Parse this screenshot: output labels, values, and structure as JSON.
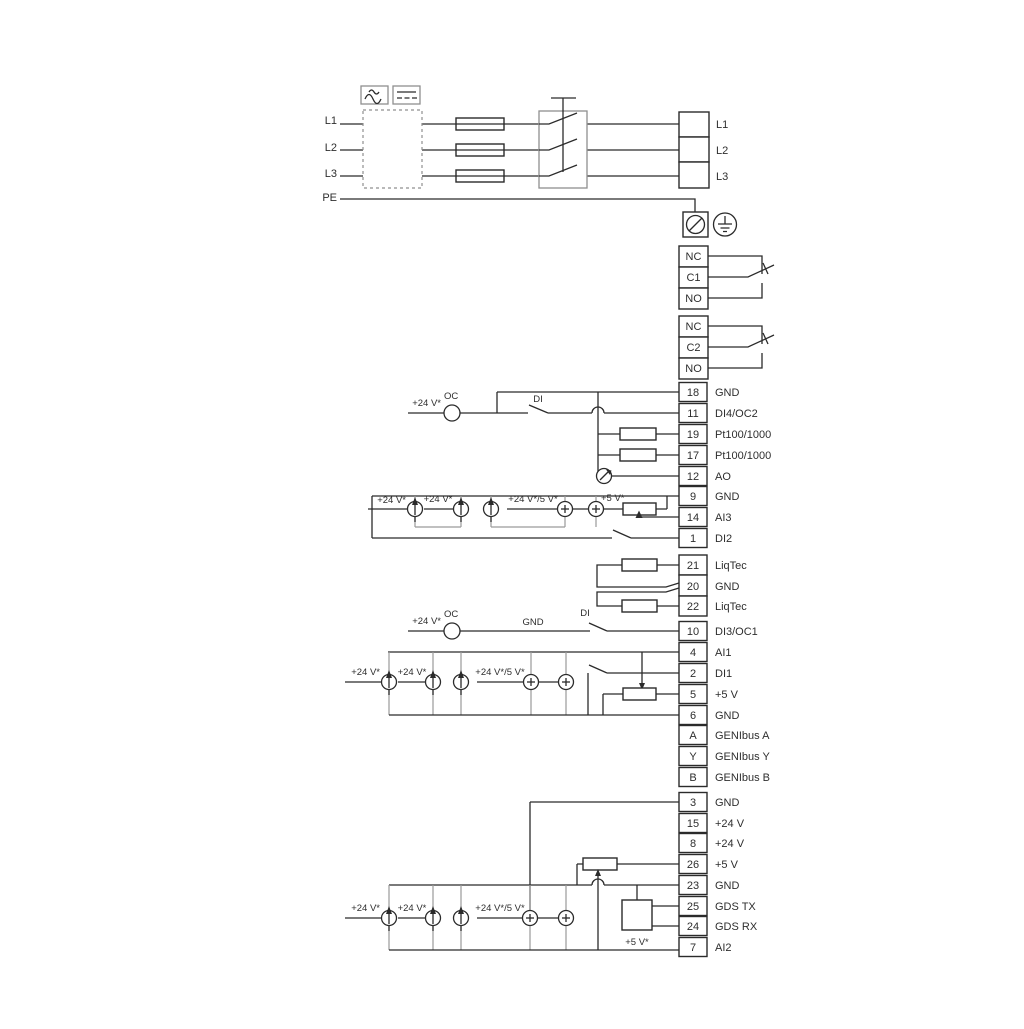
{
  "page": {
    "background": "#ffffff",
    "line_color": "#2b2b2b",
    "muted_line_color": "#9a9a9a"
  },
  "labels": {
    "v24": "+24 V*",
    "v24_5": "+24 V*/5 V*",
    "v5": "+5 V*",
    "oc": "OC",
    "di": "DI",
    "gnd": "GND"
  },
  "mains": {
    "inputs": [
      "L1",
      "L2",
      "L3",
      "PE"
    ],
    "outputs": [
      "L1",
      "L2",
      "L3"
    ]
  },
  "relays": {
    "relay1": [
      "NC",
      "C1",
      "NO"
    ],
    "relay2": [
      "NC",
      "C2",
      "NO"
    ]
  },
  "terminals": {
    "group_a": [
      {
        "n": "18",
        "label": "GND"
      },
      {
        "n": "11",
        "label": "DI4/OC2"
      },
      {
        "n": "19",
        "label": "Pt100/1000"
      },
      {
        "n": "17",
        "label": "Pt100/1000"
      },
      {
        "n": "12",
        "label": "AO"
      },
      {
        "n": "9",
        "label": "GND"
      },
      {
        "n": "14",
        "label": "AI3"
      },
      {
        "n": "1",
        "label": "DI2"
      }
    ],
    "liqtec": [
      {
        "n": "21",
        "label": "LiqTec"
      },
      {
        "n": "20",
        "label": "GND"
      },
      {
        "n": "22",
        "label": "LiqTec"
      }
    ],
    "group_b": [
      {
        "n": "10",
        "label": "DI3/OC1"
      },
      {
        "n": "4",
        "label": "AI1"
      },
      {
        "n": "2",
        "label": "DI1"
      },
      {
        "n": "5",
        "label": "+5 V"
      },
      {
        "n": "6",
        "label": "GND"
      },
      {
        "n": "A",
        "label": "GENIbus A"
      },
      {
        "n": "Y",
        "label": "GENIbus Y"
      },
      {
        "n": "B",
        "label": "GENIbus B"
      }
    ],
    "group_c": [
      {
        "n": "3",
        "label": "GND"
      },
      {
        "n": "15",
        "label": "+24 V"
      },
      {
        "n": "8",
        "label": "+24 V"
      },
      {
        "n": "26",
        "label": "+5 V"
      },
      {
        "n": "23",
        "label": "GND"
      },
      {
        "n": "25",
        "label": "GDS TX"
      },
      {
        "n": "24",
        "label": "GDS RX"
      },
      {
        "n": "7",
        "label": "AI2"
      }
    ]
  }
}
